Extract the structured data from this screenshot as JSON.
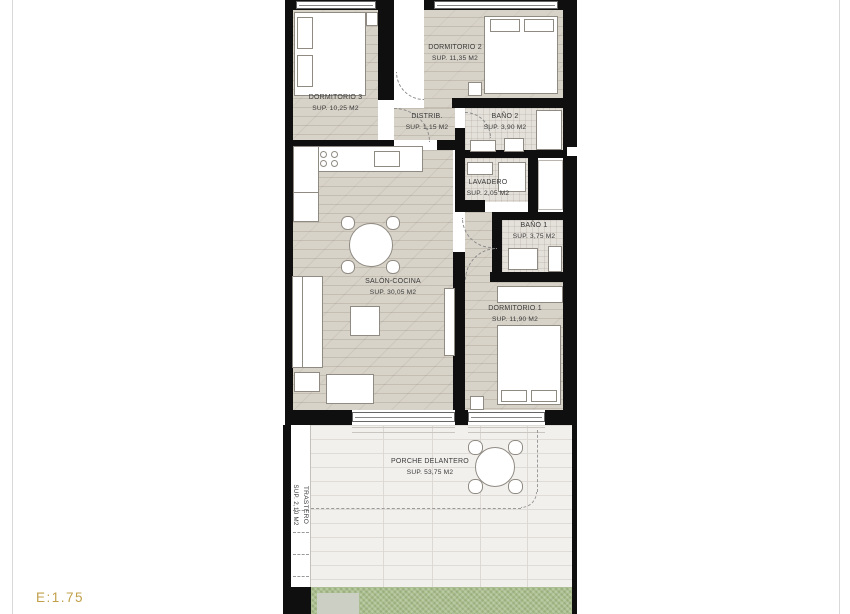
{
  "plan": {
    "scale_label": "E:1.75",
    "colors": {
      "wall": "#0f0f0f",
      "wood_floor": "#d8d3c9",
      "bath_floor": "#e4e0da",
      "porch_floor": "#f2f0ed",
      "grass": "#a9be8c",
      "scale_text": "#c1a04a"
    },
    "rooms": {
      "dormitorio3": {
        "name": "DORMITORIO 3",
        "area": "SUP. 10,25 M2"
      },
      "dormitorio2": {
        "name": "DORMITORIO 2",
        "area": "SUP. 11,35 M2"
      },
      "distrib": {
        "name": "DISTRIB.",
        "area": "SUP. 1,15 M2"
      },
      "bano2": {
        "name": "BAÑO 2",
        "area": "SUP. 3,90 M2"
      },
      "lavadero": {
        "name": "LAVADERO",
        "area": "SUP. 2,05 M2"
      },
      "bano1": {
        "name": "BAÑO 1",
        "area": "SUP. 3,75 M2"
      },
      "salon": {
        "name": "SALÓN-COCINA",
        "area": "SUP. 30,05 M2"
      },
      "dormitorio1": {
        "name": "DORMITORIO 1",
        "area": "SUP. 11,90 M2"
      },
      "porche": {
        "name": "PORCHE DELANTERO",
        "area": "SUP. 53,75 M2"
      },
      "trastero": {
        "name": "TRASTERO",
        "area": "SUP. 2,10 M2"
      }
    }
  }
}
